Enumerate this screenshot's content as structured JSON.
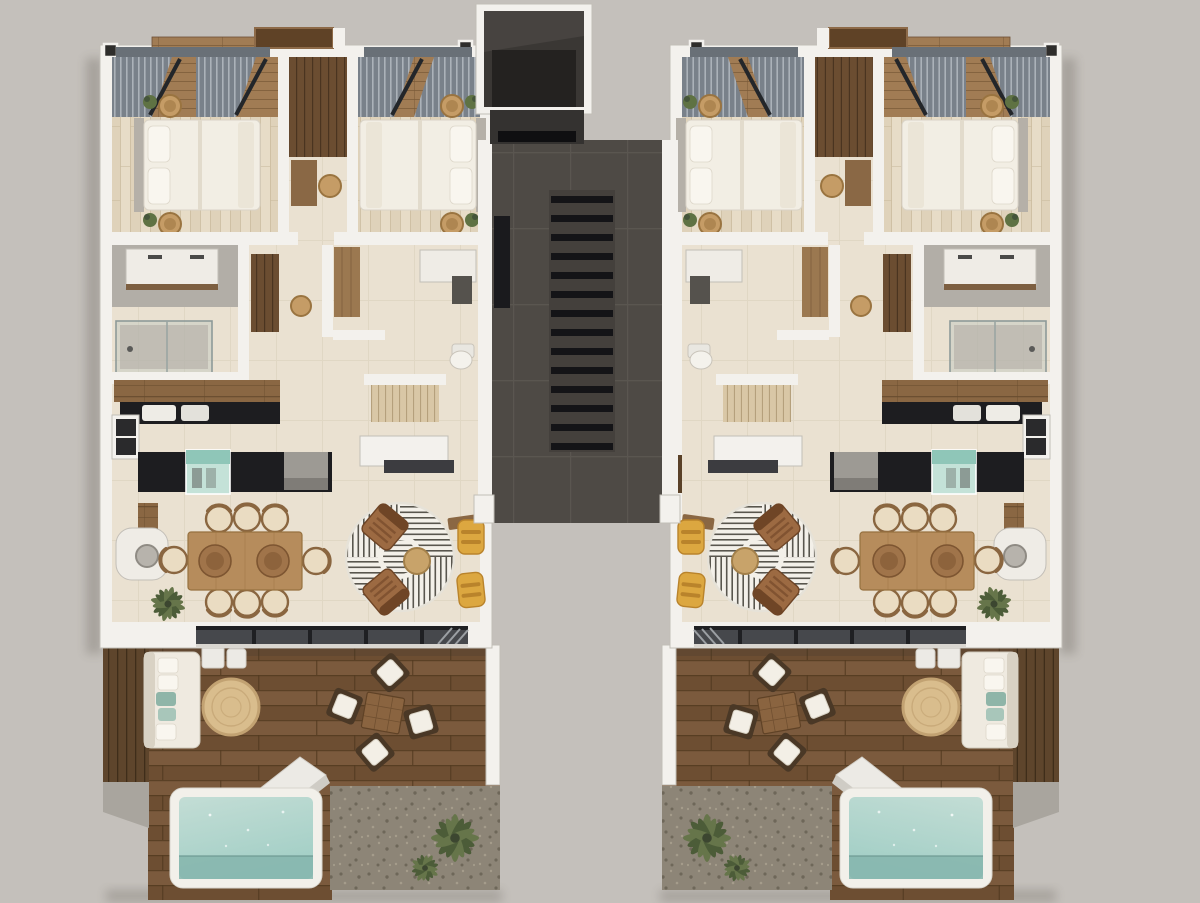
{
  "scene": {
    "description": "Top-down 3D architectural render of a residential floor plan: two mirrored apartment units flanking a central elevator and staircase core, each with two bedrooms, two bathrooms, kitchen, dining-living room, and a rear wood deck terrace with plunge pool and gravel garden with palms",
    "view": "top-down 3D render",
    "background_color": "#c4c0bb",
    "units_count": 2,
    "mirrored_units": true
  },
  "colors": {
    "bg": "#c4c0bb",
    "wallWhite": "#f3f1ed",
    "wallEdge": "#c2beb7",
    "floorCream": "#eae1d1",
    "floorLine": "#d5c9b4",
    "plankA": "#e7dcc7",
    "plankB": "#ddd0b6",
    "plankLine": "#cbbc9f",
    "slatA": "#79818a",
    "slatB": "#abb2b9",
    "beamDark": "#23262a",
    "woodCeil": "#a17c54",
    "woodCeilLine": "#7a5a38",
    "glassDark": "#697077",
    "headboard": "#b5b0a8",
    "bedWhite": "#f2eee4",
    "pillowWhite": "#f9f6ef",
    "foldShade": "#e2dbcc",
    "rattan": "#c59c66",
    "rattanDark": "#9a7440",
    "plantGreen": "#5f7243",
    "plantDark": "#45553a",
    "wardrobeWood": "#6b4d31",
    "wardrobeLine": "#4a3420",
    "bathGray": "#b2aea7",
    "vanityWhite": "#efece6",
    "counterWoodEdge": "#7d5f41",
    "showerGlass": "#b9c2bf",
    "counterBlack": "#1d1d20",
    "shelfWood": "#8a6743",
    "shelfWoodLine": "#664b2e",
    "sinkWhite": "#eeece6",
    "tealA": "#c4e2d8",
    "tealB": "#8fc6b8",
    "applianceGray": "#9d9a94",
    "pantrySlat": "#d9c7a6",
    "pantrySlatLine": "#b5a07c",
    "tableWood": "#b68c5c",
    "tableWoodDark": "#96713f",
    "trayWood": "#a0744a",
    "trayWoodDark": "#7d5531",
    "chairSeat": "#eadcc2",
    "chairWoodRim": "#8a6640",
    "rugWhite": "#f3f0e9",
    "rugLine": "#59564e",
    "armBrown": "#9c6a42",
    "armBrownDark": "#6f4526",
    "poufTan": "#c8a36a",
    "yellowA": "#dca740",
    "yellowB": "#b9832b",
    "mediaShelf": "#3c3c40",
    "doorTrack": "#46484c",
    "trackBlack": "#1f2023",
    "deckA": "#7b5a3d",
    "deckB": "#6d4e32",
    "deckLine": "#51391f",
    "screenWood": "#5e452c",
    "concrete": "#a9a59e",
    "pebbleBase": "#8d8577",
    "pebbleDark": "#6e6759",
    "pebbleLight": "#a59c8b",
    "palmA": "#66754a",
    "palmB": "#4c5c38",
    "poolRim": "#f2f0ea",
    "poolA": "#c3ddd5",
    "poolB": "#a3cfc6",
    "poolDeep": "#85b5ad",
    "jute": "#d9bd8d",
    "juteDark": "#c2a272",
    "cushionWhite": "#f3efe6",
    "outChairWood": "#4a3826",
    "benchWhite": "#eceae5",
    "tealPillow": "#8fb5a8",
    "stairTile": "#4e4a45",
    "stairGrout": "#5b5751",
    "tread": "#141417",
    "elevA": "#3a3734",
    "elevB": "#242220",
    "landing": "#343230",
    "doorBrown": "#5a4128",
    "shadow": "#3c372f"
  },
  "core": {
    "elements": [
      "elevator-shaft",
      "stair-lobby",
      "staircase",
      "unit-entry-door-left",
      "unit-entry-door-right"
    ],
    "staircase_treads": 14
  },
  "units": [
    {
      "id": "unit-left",
      "position": "left",
      "mirrored": false,
      "rooms": [
        {
          "name": "bedroom-1",
          "features": [
            "double-bed",
            "gray-headboard",
            "rattan-nightstand-x2",
            "potted-plant-x2",
            "louvered-window-shades",
            "pergola-beams",
            "plank-flooring"
          ]
        },
        {
          "name": "closet-desk-nook",
          "features": [
            "wood-wardrobe",
            "desk",
            "rattan-chair"
          ]
        },
        {
          "name": "bedroom-2",
          "features": [
            "double-bed",
            "gray-headboard",
            "rattan-nightstand-x2",
            "potted-plant-x2",
            "louvered-window-shades",
            "pergola-beams",
            "plank-flooring"
          ]
        },
        {
          "name": "bathroom-1",
          "features": [
            "double-vanity",
            "walk-in-glass-shower",
            "gray-tile-floor"
          ]
        },
        {
          "name": "hallway",
          "features": [
            "dark-wood-wardrobe-panel",
            "rattan-stool"
          ]
        },
        {
          "name": "bathroom-2",
          "features": [
            "vanity",
            "mirror-panel",
            "toilet",
            "wood-door"
          ]
        },
        {
          "name": "pantry-closet",
          "features": [
            "light-slatted-wardrobe"
          ]
        },
        {
          "name": "kitchen",
          "features": [
            "wood-shelf-run",
            "black-counter",
            "double-sink",
            "black-island",
            "glass-wine-cabinet",
            "appliance-tower"
          ]
        },
        {
          "name": "dining-area",
          "features": [
            "eight-seat-wood-table",
            "round-serving-tray-x2",
            "wicker-dining-chair-x8",
            "sideboard",
            "desk-with-chair",
            "dry-plant"
          ]
        },
        {
          "name": "living-area",
          "features": [
            "round-geometric-maze-rug",
            "brown-lounge-chair-x2",
            "rattan-pouf",
            "yellow-chaise-x2",
            "wood-bench",
            "tv-media-shelf"
          ]
        },
        {
          "name": "terrace",
          "features": [
            "wood-deck",
            "outdoor-sofa-with-teal-pillows",
            "white-side-table-x2",
            "round-jute-rug",
            "outdoor-dining-set-4-chairs",
            "white-bench",
            "privacy-screen",
            "concrete-step"
          ]
        },
        {
          "name": "plunge-pool",
          "features": [
            "white-rim",
            "aqua-water"
          ]
        },
        {
          "name": "gravel-garden",
          "features": [
            "palm-plant"
          ]
        }
      ]
    },
    {
      "id": "unit-right",
      "position": "right",
      "mirrored": true,
      "note": "identical layout mirrored horizontally"
    }
  ]
}
